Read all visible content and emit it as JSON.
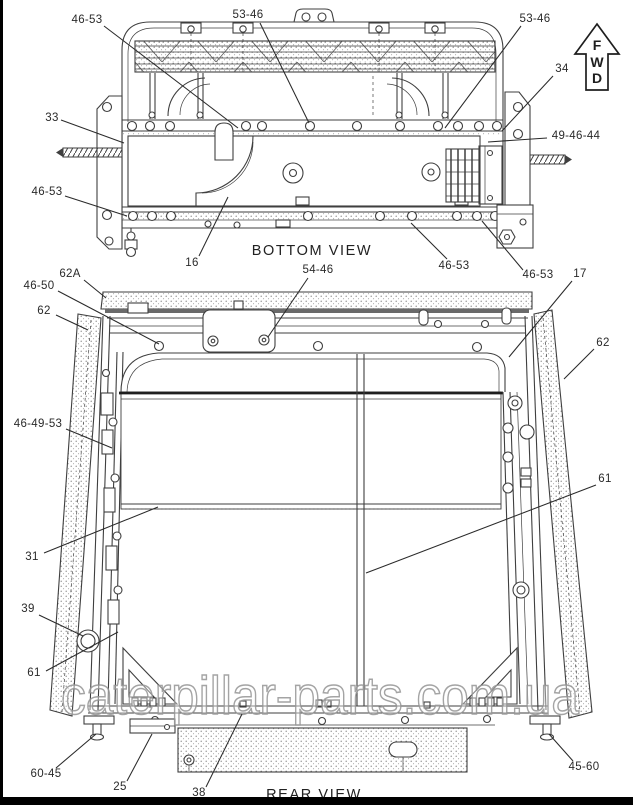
{
  "page": {
    "watermark": "caterpillar-parts.com.ua"
  },
  "views": {
    "bottom": {
      "title": "BOTTOM VIEW"
    },
    "rear": {
      "title": "REAR VIEW"
    }
  },
  "fwd_arrow": {
    "letters": [
      "F",
      "W",
      "D"
    ]
  },
  "colors": {
    "line": "#3f3f3f",
    "label": "#2a2a2a",
    "watermark_stroke": "#949494",
    "border": "#000000"
  },
  "callouts": {
    "bottom_view": [
      {
        "label": "46-53",
        "x": 87,
        "y": 23,
        "x1": 104,
        "y1": 26,
        "x2": 238,
        "y2": 128
      },
      {
        "label": "53-46",
        "x": 248,
        "y": 18,
        "x1": 260,
        "y1": 23,
        "x2": 309,
        "y2": 123
      },
      {
        "label": "53-46",
        "x": 535,
        "y": 22,
        "x1": 521,
        "y1": 26,
        "x2": 445,
        "y2": 128
      },
      {
        "label": "34",
        "x": 562,
        "y": 72,
        "x1": 553,
        "y1": 76,
        "x2": 502,
        "y2": 131
      },
      {
        "label": "49-46-44",
        "x": 576,
        "y": 139,
        "x1": 547,
        "y1": 138,
        "x2": 488,
        "y2": 142
      },
      {
        "label": "33",
        "x": 52,
        "y": 121,
        "x1": 61,
        "y1": 120,
        "x2": 124,
        "y2": 143
      },
      {
        "label": "46-53",
        "x": 47,
        "y": 195,
        "x1": 65,
        "y1": 196,
        "x2": 127,
        "y2": 216
      },
      {
        "label": "16",
        "x": 192,
        "y": 266,
        "x1": 199,
        "y1": 256,
        "x2": 228,
        "y2": 197
      },
      {
        "label": "46-53",
        "x": 454,
        "y": 269,
        "x1": 447,
        "y1": 259,
        "x2": 411,
        "y2": 223
      },
      {
        "label": "46-53",
        "x": 538,
        "y": 278,
        "x1": 523,
        "y1": 270,
        "x2": 482,
        "y2": 221
      }
    ],
    "rear_view": [
      {
        "label": "62A",
        "x": 70,
        "y": 277,
        "x1": 84,
        "y1": 280,
        "x2": 106,
        "y2": 298
      },
      {
        "label": "46-50",
        "x": 39,
        "y": 289,
        "x1": 58,
        "y1": 291,
        "x2": 159,
        "y2": 344
      },
      {
        "label": "62",
        "x": 44,
        "y": 314,
        "x1": 56,
        "y1": 315,
        "x2": 88,
        "y2": 330
      },
      {
        "label": "54-46",
        "x": 318,
        "y": 273,
        "x1": 308,
        "y1": 278,
        "x2": 268,
        "y2": 337
      },
      {
        "label": "17",
        "x": 580,
        "y": 277,
        "x1": 572,
        "y1": 281,
        "x2": 509,
        "y2": 357
      },
      {
        "label": "62",
        "x": 603,
        "y": 346,
        "x1": 594,
        "y1": 349,
        "x2": 564,
        "y2": 379
      },
      {
        "label": "46-49-53",
        "x": 38,
        "y": 427,
        "x1": 66,
        "y1": 429,
        "x2": 112,
        "y2": 448
      },
      {
        "label": "31",
        "x": 32,
        "y": 560,
        "x1": 44,
        "y1": 553,
        "x2": 158,
        "y2": 507
      },
      {
        "label": "61",
        "x": 605,
        "y": 482,
        "x1": 596,
        "y1": 485,
        "x2": 366,
        "y2": 573
      },
      {
        "label": "39",
        "x": 28,
        "y": 612,
        "x1": 39,
        "y1": 615,
        "x2": 83,
        "y2": 636
      },
      {
        "label": "61",
        "x": 34,
        "y": 676,
        "x1": 46,
        "y1": 671,
        "x2": 118,
        "y2": 632
      },
      {
        "label": "60-45",
        "x": 46,
        "y": 777,
        "x1": 56,
        "y1": 768,
        "x2": 96,
        "y2": 734
      },
      {
        "label": "25",
        "x": 120,
        "y": 790,
        "x1": 127,
        "y1": 781,
        "x2": 152,
        "y2": 734
      },
      {
        "label": "38",
        "x": 199,
        "y": 796,
        "x1": 206,
        "y1": 787,
        "x2": 242,
        "y2": 714
      },
      {
        "label": "45-60",
        "x": 584,
        "y": 770,
        "x1": 573,
        "y1": 761,
        "x2": 549,
        "y2": 734
      }
    ]
  }
}
